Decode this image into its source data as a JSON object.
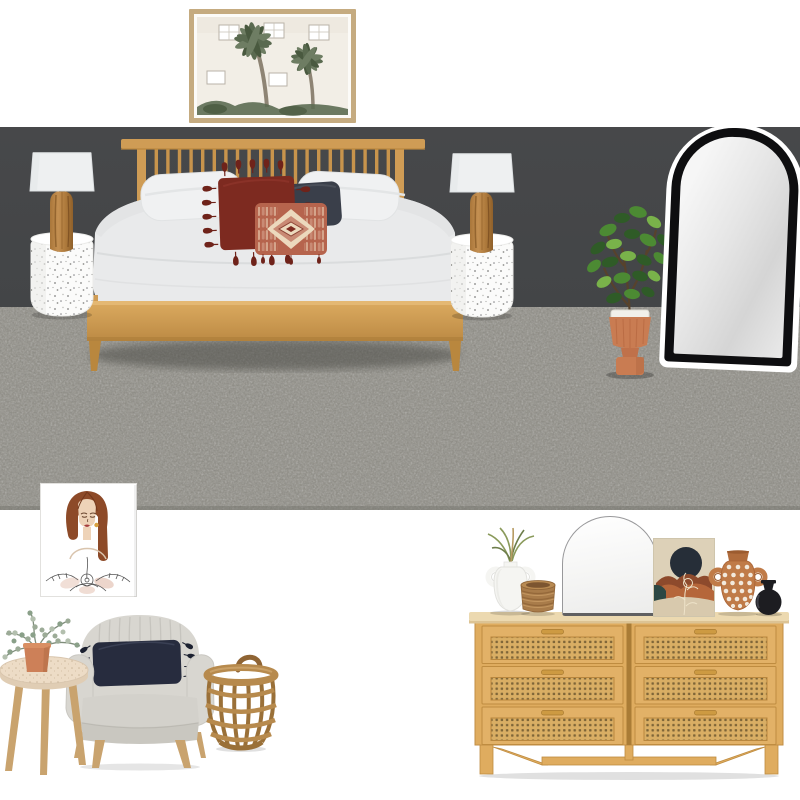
{
  "board": {
    "name": "bedroom-mood-board"
  },
  "colors": {
    "wall": "#47484a",
    "carpet": "#8e8c84",
    "oak": "#cf9c55",
    "oak2": "#c8944c",
    "oakDark": "#b9873e",
    "frame": "#c5ab80",
    "duvet": "#e9eaeb",
    "shade": "#eef0f1",
    "maroon": "#7d2a20",
    "maroon2": "#6f231a",
    "navy": "#3a3f4a",
    "lumbar": "#b6644d",
    "lumbarRose": "#c98a74",
    "lumbarCream": "#ecd9bd",
    "figDark": "#2f5b27",
    "figMid": "#4c8a33",
    "figLight": "#79b24a",
    "terracotta": "#c97c52",
    "mirrorFrame": "#0e0e10",
    "chair": "#d8d6d0",
    "navyCushion": "#272c3e",
    "woodLeg": "#c9a36e",
    "tabletop": "#eddcc6",
    "potSmall": "#cd8058",
    "euc": "#9cab97",
    "basket": "#b78a4d",
    "basketD": "#9a7038",
    "dresser": "#dfac5f",
    "dresserTop": "#ecd9b0",
    "rattan": "#d9ae64",
    "rattanHole": "#6f5830",
    "whiteItem": "#f5f5f2",
    "rope": "#a97c4a",
    "printBg": "#ddd1b8",
    "printNavy": "#262e38",
    "printRust": "#b5663a",
    "printRustD": "#8d4a2c",
    "printTeal": "#2c4743",
    "printCream": "#d8c9ad",
    "polka": "#c07b48",
    "blackVase": "#1d1d21",
    "hair": "#8d4a28",
    "skin": "#eed3b8",
    "lips": "#a63e3e",
    "grass": "#8a9a5b"
  },
  "items": [
    {
      "label": "Charcoal wall paint swatch"
    },
    {
      "label": "Grey carpet flooring swatch"
    },
    {
      "label": "Palm tree framed art print"
    },
    {
      "label": "Oak spindle timber bed with white bedding"
    },
    {
      "label": "Rust tassel cushion"
    },
    {
      "label": "Navy cushion"
    },
    {
      "label": "Terracotta diamond lumbar cushion"
    },
    {
      "label": "White terrazzo side table left"
    },
    {
      "label": "Timber log table lamp left"
    },
    {
      "label": "White terrazzo side table right"
    },
    {
      "label": "Timber log table lamp right"
    },
    {
      "label": "Fiddle leaf fig in terracotta planter"
    },
    {
      "label": "Black arch full length mirror"
    },
    {
      "label": "Female portrait line art print"
    },
    {
      "label": "Grey channel stitch armchair"
    },
    {
      "label": "Navy tassel lumbar cushion"
    },
    {
      "label": "Round timber side table"
    },
    {
      "label": "Potted eucalyptus"
    },
    {
      "label": "Open weave cane basket"
    },
    {
      "label": "Rattan six drawer dresser"
    },
    {
      "label": "White arch vanity mirror"
    },
    {
      "label": "White vase with dried grass"
    },
    {
      "label": "Brown rope basket"
    },
    {
      "label": "Abstract arch landscape art print"
    },
    {
      "label": "Terracotta spot vase"
    },
    {
      "label": "Black bud vase"
    }
  ]
}
